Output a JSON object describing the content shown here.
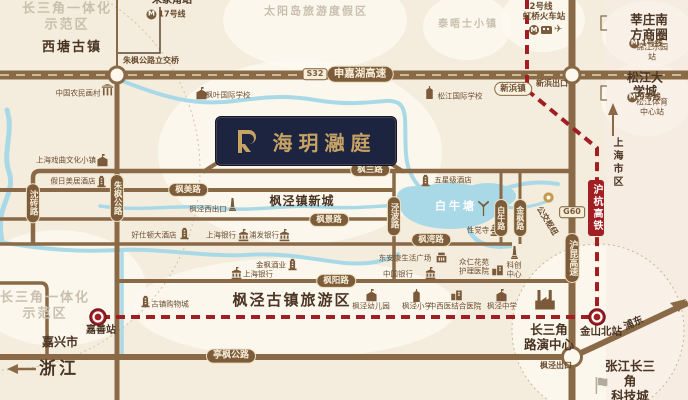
{
  "colors": {
    "background": "#f4edde",
    "road": "#8a6a46",
    "road_pill": "#7c5c3a",
    "rail_red": "#a11e22",
    "water": "#a9d9e7",
    "project_navy": "#1d2440",
    "project_gold": "#c6a265",
    "zone_text": "#c9bfae",
    "town_text": "#4a3423"
  },
  "badge": {
    "title": "海玥瀜庭"
  },
  "icons": {
    "metro_m": "M",
    "plane": "✈"
  },
  "labels": [
    {
      "n": "zone-csj-top",
      "c": "zone",
      "t": "长三角一体化\n示范区",
      "x": 67,
      "y": 17,
      "fs": 13
    },
    {
      "n": "zone-sun-island",
      "c": "zone",
      "t": "太阳岛旅游度假区",
      "x": 316,
      "y": 11,
      "fs": 11
    },
    {
      "n": "zone-thames-town",
      "c": "zone",
      "t": "泰晤士小镇",
      "x": 468,
      "y": 25,
      "fs": 10
    },
    {
      "n": "zone-csj-bottom",
      "c": "zone",
      "t": "长三角一体化\n示范区",
      "x": 45,
      "y": 306,
      "fs": 13
    },
    {
      "n": "town-xitang",
      "c": "town",
      "t": "西塘古镇",
      "x": 72,
      "y": 48,
      "fs": 13,
      "ls": 2
    },
    {
      "n": "town-fengjing-newtown",
      "c": "town",
      "t": "枫泾镇新城",
      "x": 302,
      "y": 201,
      "fs": 12,
      "ls": 1
    },
    {
      "n": "town-fengjing-oldtown",
      "c": "town",
      "t": "枫泾古镇旅游区",
      "x": 292,
      "y": 300,
      "fs": 15,
      "ls": 2
    },
    {
      "n": "town-jiaxing",
      "c": "town",
      "t": "嘉兴市",
      "x": 60,
      "y": 342,
      "fs": 12
    },
    {
      "n": "town-zhejiang",
      "c": "town",
      "t": "浙江",
      "x": 59,
      "y": 369,
      "fs": 17,
      "ls": 3
    },
    {
      "n": "town-xinzhuang-cbd",
      "c": "town",
      "t": "莘庄南方商圈",
      "x": 649,
      "y": 27,
      "fs": 12.5
    },
    {
      "n": "town-songjiang-univ",
      "c": "town",
      "t": "松江大学城",
      "x": 645,
      "y": 85,
      "fs": 12
    },
    {
      "n": "town-roadshow-center",
      "c": "town",
      "t": "长三角\n路演中心",
      "x": 549,
      "y": 337,
      "fs": 12.5
    },
    {
      "n": "town-zhangjiang-tech",
      "c": "town",
      "t": "张江长三角\n科技城",
      "x": 630,
      "y": 381,
      "fs": 12.5
    },
    {
      "n": "station-jinshan-north",
      "c": "town",
      "t": "金山北站",
      "x": 601,
      "y": 332,
      "fs": 10.5
    },
    {
      "n": "station-jiashan",
      "c": "town",
      "t": "嘉善站",
      "x": 101,
      "y": 331,
      "fs": 10
    },
    {
      "n": "station-zhujiajiao",
      "c": "town",
      "t": "朱家角站",
      "x": 172,
      "y": 1,
      "fs": 10
    },
    {
      "n": "label-shanghai-downtown",
      "c": "townv",
      "t": "上海市区",
      "x": 616,
      "y": 163,
      "fs": 10
    },
    {
      "n": "label-pudong",
      "c": "town",
      "t": "浦东",
      "x": 634,
      "y": 324,
      "fs": 10,
      "rot": -25
    },
    {
      "n": "pond-bainiutang",
      "c": "pond",
      "t": "白牛塘",
      "x": 456,
      "y": 206,
      "fs": 11
    },
    {
      "n": "label-interchange",
      "c": "tinyb",
      "t": "朱枫公路立交桥",
      "x": 151,
      "y": 61,
      "fs": 8
    },
    {
      "n": "label-xinbang-exit",
      "c": "tinyb",
      "t": "新浜出口",
      "x": 552,
      "y": 84,
      "fs": 8
    },
    {
      "n": "label-fengjing-exit",
      "c": "tinyb",
      "t": "枫泾出口",
      "x": 556,
      "y": 366,
      "fs": 8
    },
    {
      "n": "label-bus-hub",
      "c": "tinyb",
      "t": "公交枢纽",
      "x": 547,
      "y": 221,
      "fs": 8,
      "rot": 58
    },
    {
      "n": "pill-xinbang-town",
      "c": "pillo",
      "t": "新浜镇",
      "x": 513,
      "y": 89,
      "fs": 8.5
    },
    {
      "n": "metro-2-line",
      "c": "tinyb",
      "t": "2号线",
      "x": 541,
      "y": 7,
      "fs": 8.5
    },
    {
      "n": "metro-2-station",
      "c": "tinyb",
      "t": "虹桥火车站",
      "x": 544,
      "y": 17,
      "fs": 8.5
    },
    {
      "n": "metro-1-station",
      "c": "tiny",
      "t": "锦江乐园站",
      "x": 652,
      "y": 52,
      "fs": 8
    },
    {
      "n": "metro-9-station",
      "c": "tiny",
      "t": "松江体育中心站",
      "x": 652,
      "y": 107,
      "fs": 8
    },
    {
      "n": "pill-shenjiahu",
      "c": "pill",
      "t": "申嘉湖高速",
      "x": 360,
      "y": 74,
      "fs": 10.5
    },
    {
      "n": "badge-s32",
      "c": "badge",
      "t": "S32",
      "x": 315,
      "y": 74,
      "fs": 8
    },
    {
      "n": "pill-fengmei",
      "c": "pill",
      "t": "枫美路",
      "x": 188,
      "y": 190,
      "fs": 8.5
    },
    {
      "n": "pill-fenglan",
      "c": "pill",
      "t": "枫兰路",
      "x": 370,
      "y": 170,
      "fs": 8.5
    },
    {
      "n": "pill-fengjing-rd",
      "c": "pill",
      "t": "枫景路",
      "x": 329,
      "y": 220,
      "fs": 8.5
    },
    {
      "n": "pill-fengwan",
      "c": "pill",
      "t": "枫湾路",
      "x": 431,
      "y": 240,
      "fs": 8.5
    },
    {
      "n": "pill-fengyang",
      "c": "pill",
      "t": "枫阳路",
      "x": 336,
      "y": 281,
      "fs": 8.5
    },
    {
      "n": "pill-tingfeng",
      "c": "pill",
      "t": "亭枫公路",
      "x": 231,
      "y": 356,
      "fs": 9
    },
    {
      "n": "pill-zhufeng",
      "c": "pillv",
      "t": "朱枫公路",
      "x": 117,
      "y": 198,
      "fs": 8.5
    },
    {
      "n": "pill-shenzhuan",
      "c": "pillv",
      "t": "沈砖路",
      "x": 33,
      "y": 203,
      "fs": 8.5
    },
    {
      "n": "pill-jingbo",
      "c": "pillv",
      "t": "泾波路",
      "x": 394,
      "y": 216,
      "fs": 8.5
    },
    {
      "n": "pill-bainiu",
      "c": "pillv",
      "t": "白牛路",
      "x": 501,
      "y": 218,
      "fs": 8
    },
    {
      "n": "pill-jinfeng",
      "c": "pillv",
      "t": "金枫路",
      "x": 520,
      "y": 218,
      "fs": 8
    },
    {
      "n": "pill-hukun",
      "c": "pillv",
      "t": "沪昆高速",
      "x": 572,
      "y": 258,
      "fs": 9
    },
    {
      "n": "badge-g60",
      "c": "badge",
      "t": "G60",
      "x": 572,
      "y": 212,
      "fs": 8
    },
    {
      "n": "rail-huhang",
      "c": "railv",
      "t": "沪杭高铁",
      "x": 596,
      "y": 208,
      "fs": 10
    }
  ],
  "metro_lines": [
    {
      "n": "metro-17-line",
      "t": "17号线",
      "x": 166,
      "y": 14
    },
    {
      "n": "metro-1-line",
      "t": "1号线",
      "x": 646,
      "y": 43
    },
    {
      "n": "metro-9-line",
      "t": "9号线",
      "x": 644,
      "y": 97
    }
  ],
  "pois": [
    {
      "n": "poi-farmer-painting-village",
      "icon": "gate",
      "ix": 107,
      "iy": 90,
      "t": "中国农民画村",
      "lx": 78,
      "ly": 93
    },
    {
      "n": "poi-fengye-intl-school",
      "icon": "school",
      "ix": 201,
      "iy": 93,
      "t": "枫叶国际学校",
      "lx": 228,
      "ly": 95
    },
    {
      "n": "poi-songjiang-intl-school",
      "icon": "church",
      "ix": 429,
      "iy": 92,
      "t": "松江国际学校",
      "lx": 460,
      "ly": 96
    },
    {
      "n": "poi-opera-culture-town",
      "icon": "school",
      "ix": 102,
      "iy": 160,
      "t": "上海戏曲文化小镇",
      "lx": 66,
      "ly": 160
    },
    {
      "n": "poi-mercure-hotel",
      "icon": "hotel",
      "ix": 101,
      "iy": 181,
      "t": "假日美居酒店",
      "lx": 73,
      "ly": 181
    },
    {
      "n": "poi-haoshidun-hotel",
      "icon": "hotel",
      "ix": 184,
      "iy": 233,
      "t": "好仕顿大酒店",
      "lx": 154,
      "ly": 235
    },
    {
      "n": "poi-bank-of-shanghai",
      "icon": "bank",
      "ix": 243,
      "iy": 235,
      "t": "上海银行",
      "lx": 221,
      "ly": 235
    },
    {
      "n": "poi-spd-bank",
      "icon": "bank",
      "ix": 284,
      "iy": 235,
      "t": "浦发银行",
      "lx": 264,
      "ly": 235
    },
    {
      "n": "poi-bank-of-shanghai-2",
      "icon": "bank",
      "ix": 236,
      "iy": 273,
      "t": "上海银行",
      "lx": 258,
      "ly": 274
    },
    {
      "n": "poi-jinfeng-winery",
      "icon": "hotel",
      "ix": 292,
      "iy": 264,
      "t": "金枫酒业",
      "lx": 271,
      "ly": 265
    },
    {
      "n": "poi-oldtown-mall",
      "icon": "hotel",
      "ix": 145,
      "iy": 301,
      "t": "古镇购物城",
      "lx": 170,
      "ly": 304
    },
    {
      "n": "poi-five-star-hotel",
      "icon": "hotel",
      "ix": 425,
      "iy": 180,
      "t": "五星级酒店",
      "lx": 453,
      "ly": 180
    },
    {
      "n": "poi-xingjue-temple",
      "icon": "temple",
      "ix": 495,
      "iy": 229,
      "t": "性觉寺",
      "lx": 478,
      "ly": 230
    },
    {
      "n": "poi-life-plaza",
      "icon": "mall",
      "ix": 441,
      "iy": 257,
      "t": "东安康生活广场",
      "lx": 405,
      "ly": 258
    },
    {
      "n": "poi-bank-of-china",
      "icon": "bank",
      "ix": 430,
      "iy": 273,
      "t": "中国银行",
      "lx": 398,
      "ly": 274
    },
    {
      "n": "poi-nursing-hospital",
      "icon": "hospital",
      "ix": 497,
      "iy": 269,
      "t": "众仁花苑\n护理医院",
      "lx": 474,
      "ly": 267
    },
    {
      "n": "poi-tech-center",
      "icon": "monument",
      "ix": 514,
      "iy": 252,
      "t": "科创\n中心",
      "lx": 514,
      "ly": 270
    },
    {
      "n": "poi-fengjing-kindergarten",
      "icon": "school",
      "ix": 371,
      "iy": 295,
      "t": "枫泾幼儿园",
      "lx": 371,
      "ly": 306
    },
    {
      "n": "poi-fengjing-primary",
      "icon": "church",
      "ix": 416,
      "iy": 295,
      "t": "枫泾小学",
      "lx": 417,
      "ly": 306
    },
    {
      "n": "poi-tcm-hospital",
      "icon": "hospital",
      "ix": 456,
      "iy": 294,
      "t": "中西医结合医院",
      "lx": 455,
      "ly": 306
    },
    {
      "n": "poi-fengjing-middle",
      "icon": "school",
      "ix": 501,
      "iy": 295,
      "t": "枫泾中学",
      "lx": 502,
      "ly": 306
    },
    {
      "n": "poi-factory",
      "icon": "factory",
      "ix": 545,
      "iy": 299,
      "t": "",
      "sz": 24
    },
    {
      "n": "poi-windmill",
      "icon": "windmill",
      "ix": 483,
      "iy": 207,
      "t": "",
      "sz": 17
    },
    {
      "n": "poi-west-exit",
      "icon": "monument",
      "ix": 232,
      "iy": 204,
      "t": "枫泾西出口",
      "lx": 208,
      "ly": 209
    },
    {
      "n": "poi-tech-city-flag",
      "icon": "flag",
      "ix": 601,
      "iy": 385,
      "t": "",
      "sz": 17,
      "gray": true
    },
    {
      "n": "poi-bus-hub-dot",
      "icon": "busdot",
      "ix": 548,
      "iy": 197,
      "t": "",
      "sz": 11
    }
  ]
}
